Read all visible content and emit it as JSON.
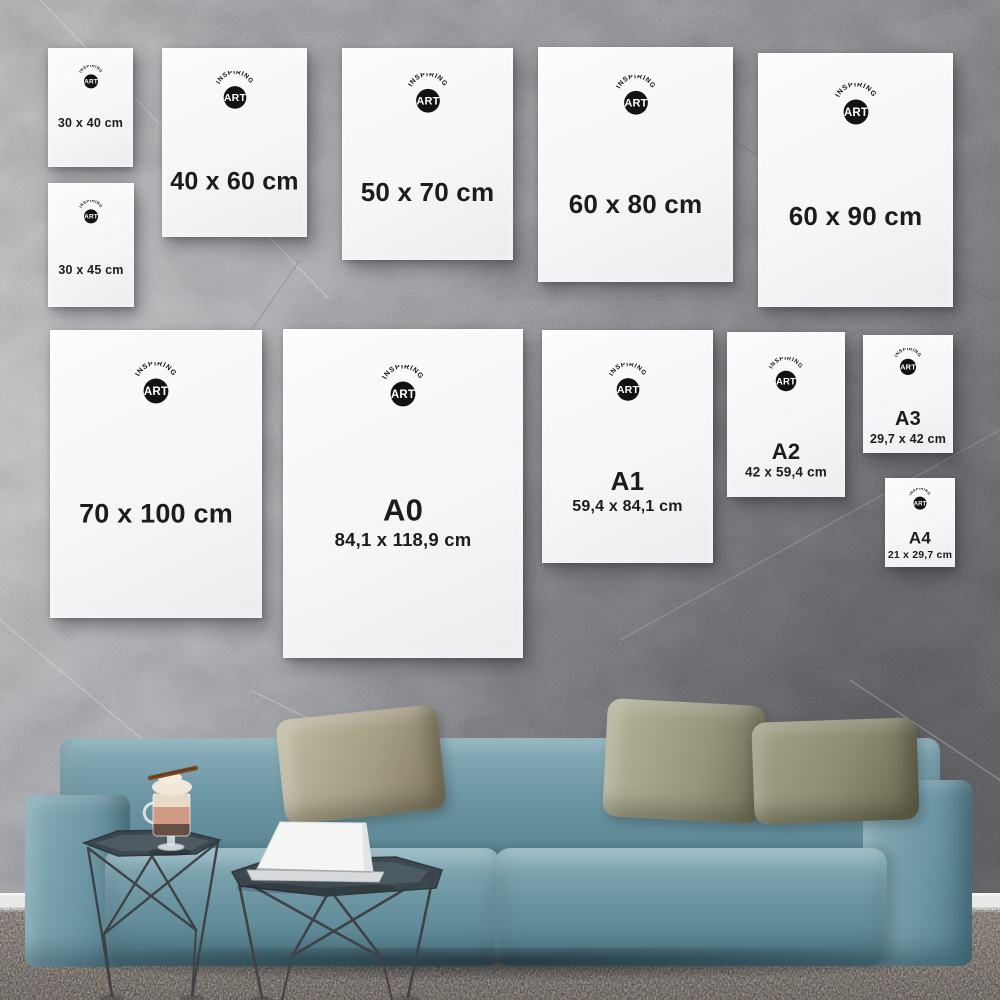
{
  "brand": {
    "arc_text": "INSPIRING",
    "circle_text": "ART"
  },
  "palette": {
    "ink": "#1c1c1e",
    "wall1": "#b8b8ba",
    "wall2": "#a2a3a7",
    "wall3": "#808185",
    "baseboard": "#e8e8e6",
    "carpet1": "#958e89",
    "carpet2": "#7b7470",
    "sofa1": "#8ab0bb",
    "sofa2": "#6d96a3",
    "sofa3": "#527d8b",
    "pillowA": "#a49e85",
    "pillowB": "#96967c",
    "metal": "#3f4245",
    "glass_top": "#39444a",
    "laptop": "#f5f5f6",
    "laptop_base": "#d7d9db",
    "cream": "#f0e7d8",
    "peach": "#d08f75",
    "mocha": "#53392c",
    "logo_circle": "#121214",
    "logo_text": "#ffffff"
  },
  "posters": [
    {
      "id": "30x40",
      "label": "30 x 40 cm",
      "x": 48,
      "y": 48,
      "w": 85,
      "h": 119,
      "font": 12.5,
      "logo": 26,
      "logoY": 14,
      "lblY": 63
    },
    {
      "id": "40x60",
      "label": "40 x 60 cm",
      "x": 162,
      "y": 48,
      "w": 145,
      "h": 189,
      "font": 25,
      "logo": 42,
      "logoY": 12,
      "lblY": 71
    },
    {
      "id": "50x70",
      "label": "50 x 70 cm",
      "x": 342,
      "y": 48,
      "w": 171,
      "h": 212,
      "font": 26,
      "logo": 44,
      "logoY": 12,
      "lblY": 68
    },
    {
      "id": "60x80",
      "label": "60 x 80 cm",
      "x": 538,
      "y": 47,
      "w": 195,
      "h": 235,
      "font": 26,
      "logo": 44,
      "logoY": 12,
      "lblY": 67
    },
    {
      "id": "60x90",
      "label": "60 x 90 cm",
      "x": 758,
      "y": 53,
      "w": 195,
      "h": 254,
      "font": 26,
      "logo": 46,
      "logoY": 12,
      "lblY": 64
    },
    {
      "id": "30x45",
      "label": "30 x 45 cm",
      "x": 48,
      "y": 183,
      "w": 86,
      "h": 124,
      "font": 12.5,
      "logo": 26,
      "logoY": 14,
      "lblY": 70
    },
    {
      "id": "70x100",
      "label": "70 x 100 cm",
      "x": 50,
      "y": 330,
      "w": 212,
      "h": 288,
      "font": 27,
      "logo": 46,
      "logoY": 11,
      "lblY": 64
    },
    {
      "id": "A0",
      "label": "A0",
      "sub": "84,1 x 118,9 cm",
      "x": 283,
      "y": 329,
      "w": 240,
      "h": 329,
      "font": 31,
      "subFont": 18.5,
      "logo": 46,
      "logoY": 11,
      "lblY": 55,
      "subY": 64
    },
    {
      "id": "A1",
      "label": "A1",
      "sub": "59,4 x 84,1 cm",
      "x": 542,
      "y": 330,
      "w": 171,
      "h": 233,
      "font": 26,
      "subFont": 16,
      "logo": 42,
      "logoY": 14,
      "lblY": 65,
      "subY": 76
    },
    {
      "id": "A2",
      "label": "A2",
      "sub": "42 x 59,4 cm",
      "x": 727,
      "y": 332,
      "w": 118,
      "h": 165,
      "font": 22,
      "subFont": 13.5,
      "logo": 38,
      "logoY": 15,
      "lblY": 73,
      "subY": 85
    },
    {
      "id": "A3",
      "label": "A3",
      "sub": "29,7 x 42 cm",
      "x": 863,
      "y": 335,
      "w": 90,
      "h": 118,
      "font": 20,
      "subFont": 12.5,
      "logo": 30,
      "logoY": 11,
      "lblY": 71,
      "subY": 88
    },
    {
      "id": "A4",
      "label": "A4",
      "sub": "21 x 29,7 cm",
      "x": 885,
      "y": 478,
      "w": 70,
      "h": 89,
      "font": 17,
      "subFont": 10.5,
      "logo": 24,
      "logoY": 11,
      "lblY": 67,
      "subY": 87
    }
  ],
  "scene_objects": [
    {
      "name": "sofa",
      "color": "#6d96a3"
    },
    {
      "name": "pillow-khaki",
      "color": "#a49e85"
    },
    {
      "name": "pillow-olive",
      "color": "#96967c"
    },
    {
      "name": "side-table-wireframe",
      "color": "#3f4245"
    },
    {
      "name": "laptop",
      "color": "#f5f5f6"
    },
    {
      "name": "dessert-glass",
      "color": "#d08f75"
    },
    {
      "name": "carpet",
      "color": "#8b8480"
    },
    {
      "name": "concrete-wall",
      "color": "#9d9ea2"
    }
  ]
}
